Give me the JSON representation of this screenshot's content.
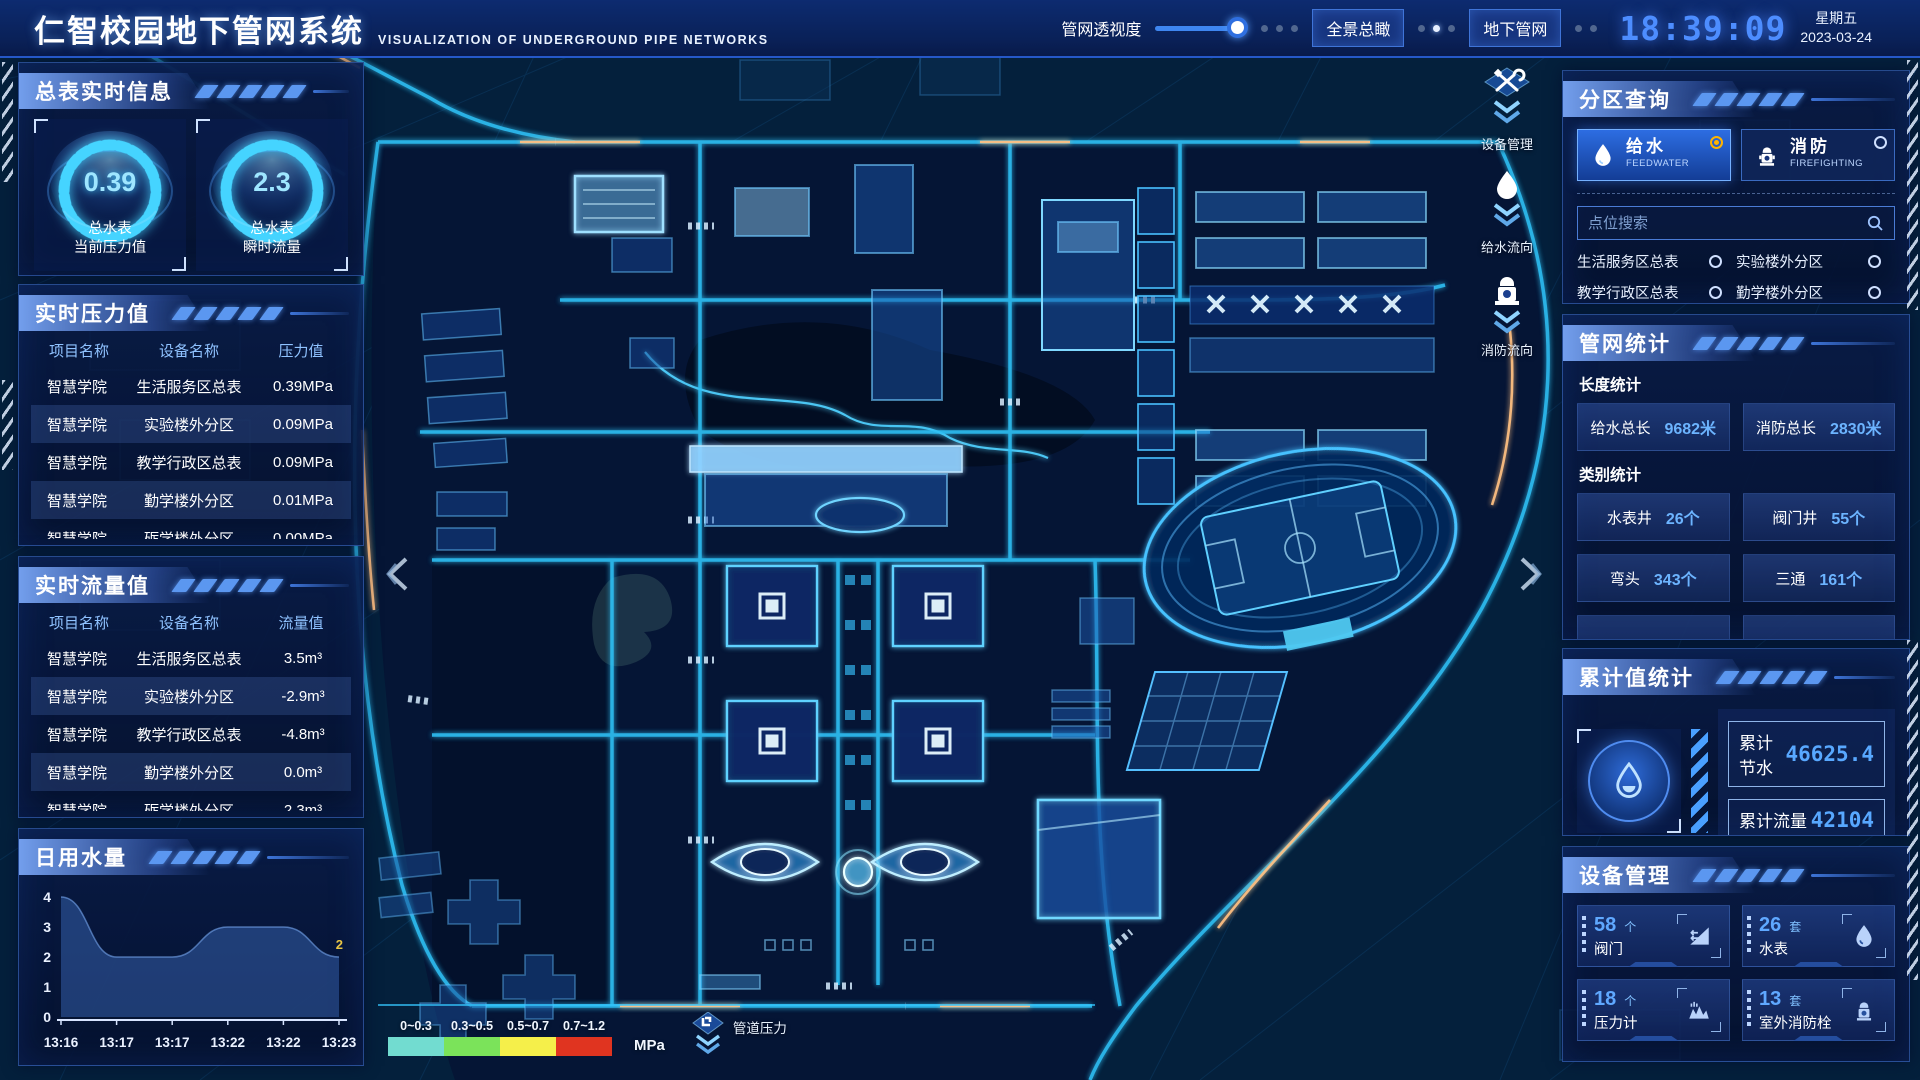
{
  "header": {
    "title": "仁智校园地下管网系统",
    "subtitle": "VISUALIZATION OF UNDERGROUND PIPE NETWORKS",
    "transparency_label": "管网透视度",
    "btn_overview": "全景总瞰",
    "btn_underground": "地下管网",
    "clock": "18:39:09",
    "weekday": "星期五",
    "date": "2023-03-24"
  },
  "left": {
    "meter_panel": {
      "title": "总表实时信息",
      "gauges": [
        {
          "value": "0.39",
          "label1": "总水表",
          "label2": "当前压力值"
        },
        {
          "value": "2.3",
          "label1": "总水表",
          "label2": "瞬时流量"
        }
      ]
    },
    "pressure_panel": {
      "title": "实时压力值",
      "headers": [
        "项目名称",
        "设备名称",
        "压力值"
      ],
      "rows": [
        [
          "智慧学院",
          "生活服务区总表",
          "0.39MPa"
        ],
        [
          "智慧学院",
          "实验楼外分区",
          "0.09MPa"
        ],
        [
          "智慧学院",
          "教学行政区总表",
          "0.09MPa"
        ],
        [
          "智慧学院",
          "勤学楼外分区",
          "0.01MPa"
        ],
        [
          "智慧学院",
          "砺学楼外分区",
          "0.00MPa"
        ]
      ]
    },
    "flow_panel": {
      "title": "实时流量值",
      "headers": [
        "项目名称",
        "设备名称",
        "流量值"
      ],
      "rows": [
        [
          "智慧学院",
          "生活服务区总表",
          "3.5m³"
        ],
        [
          "智慧学院",
          "实验楼外分区",
          "-2.9m³"
        ],
        [
          "智慧学院",
          "教学行政区总表",
          "-4.8m³"
        ],
        [
          "智慧学院",
          "勤学楼外分区",
          "0.0m³"
        ],
        [
          "智慧学院",
          "砺学楼外分区",
          "2.3m³"
        ]
      ]
    },
    "daily_panel": {
      "title": "日用水量"
    }
  },
  "chart_data": {
    "type": "area",
    "title": "日用水量",
    "x": [
      "13:16",
      "13:17",
      "13:17",
      "13:22",
      "13:22",
      "13:23"
    ],
    "values": [
      4,
      2,
      2,
      3,
      3,
      2
    ],
    "ylim": [
      0,
      4
    ],
    "yticks": [
      0,
      1,
      2,
      3,
      4
    ],
    "grid": false,
    "last_point_label": "2",
    "area_color": "#3f6fc0",
    "label_color": "#e8c545"
  },
  "right": {
    "zone_panel": {
      "title": "分区查询",
      "feedwater_cn": "给水",
      "feedwater_en": "FEEDWATER",
      "firefighting_cn": "消防",
      "firefighting_en": "FIREFIGHTING",
      "search_placeholder": "点位搜索",
      "items": [
        "生活服务区总表",
        "实验楼外分区",
        "教学行政区总表",
        "勤学楼外分区",
        "砺学楼外分区",
        "宿舍区泵房"
      ]
    },
    "stats_panel": {
      "title": "管网统计",
      "length_label": "长度统计",
      "length_stats": [
        {
          "label": "给水总长",
          "value": "9682米"
        },
        {
          "label": "消防总长",
          "value": "2830米"
        }
      ],
      "category_label": "类别统计",
      "category_stats": [
        {
          "label": "水表井",
          "value": "26个"
        },
        {
          "label": "阀门井",
          "value": "55个"
        },
        {
          "label": "弯头",
          "value": "343个"
        },
        {
          "label": "三通",
          "value": "161个"
        }
      ]
    },
    "cumulative_panel": {
      "title": "累计值统计",
      "rows": [
        {
          "label": "累计节水",
          "value": "46625.4"
        },
        {
          "label": "累计流量",
          "value": "42104"
        }
      ]
    },
    "device_panel": {
      "title": "设备管理",
      "cards": [
        {
          "count": "58",
          "unit": "个",
          "label": "阀门"
        },
        {
          "count": "26",
          "unit": "套",
          "label": "水表"
        },
        {
          "count": "18",
          "unit": "个",
          "label": "压力计"
        },
        {
          "count": "13",
          "unit": "套",
          "label": "室外消防栓"
        }
      ]
    }
  },
  "map": {
    "tools": [
      {
        "label": "设备管理"
      },
      {
        "label": "给水流向"
      },
      {
        "label": "消防流向"
      }
    ],
    "legend": {
      "ranges": [
        "0~0.3",
        "0.3~0.5",
        "0.5~0.7",
        "0.7~1.2"
      ],
      "colors": [
        "#72dcd0",
        "#7be35a",
        "#f5ef4a",
        "#e03420"
      ],
      "unit": "MPa",
      "pipe_pressure_label": "管道压力"
    },
    "accent_color": "#2fc0f5"
  }
}
